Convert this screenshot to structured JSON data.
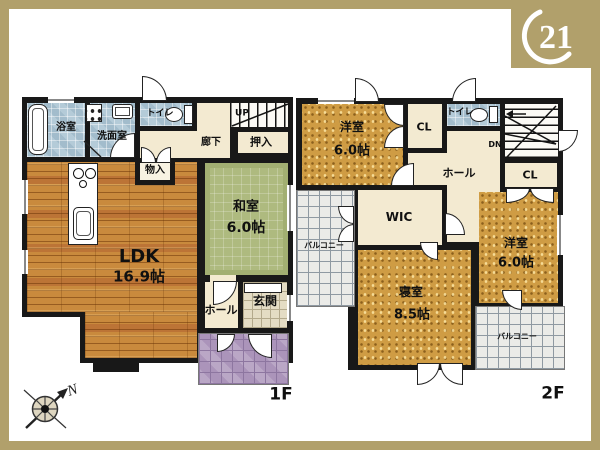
{
  "logo": {
    "number": "21"
  },
  "compass": {
    "north_label": "N"
  },
  "floor1": {
    "label": "1F",
    "rooms": {
      "bath": "浴室",
      "washroom": "洗面室",
      "toilet": "トイレ",
      "stairs_up": "UP",
      "corridor": "廊下",
      "oshiire": "押入",
      "storage": "物入",
      "washitsu_name": "和室",
      "washitsu_size": "6.0帖",
      "ldk_name": "LDK",
      "ldk_size": "16.9帖",
      "hall": "ホール",
      "genkan": "玄関"
    }
  },
  "floor2": {
    "label": "2F",
    "rooms": {
      "yoshitsu1_name": "洋室",
      "yoshitsu1_size": "6.0帖",
      "closet1": "CL",
      "toilet": "トイレ",
      "stairs_dn": "DN",
      "hall": "ホール",
      "closet2": "CL",
      "wic": "WIC",
      "bedroom_name": "寝室",
      "bedroom_size": "8.5帖",
      "yoshitsu2_name": "洋室",
      "yoshitsu2_size": "6.0帖",
      "balcony_left": "バルコニー",
      "balcony_right": "バルコニー"
    }
  },
  "colors": {
    "frame_gold": "#b1a06b",
    "wall": "#181818",
    "wood_floor": "#c98a3d",
    "tatami_green": "#aeba7f",
    "carpet_gold": "#cf9c44",
    "wet_tile_blue": "#b4cbd8",
    "porch_tile_purple": "#ab94ba",
    "genkan_tile": "#e4dcc4",
    "hall_beige": "#f3ead1"
  }
}
